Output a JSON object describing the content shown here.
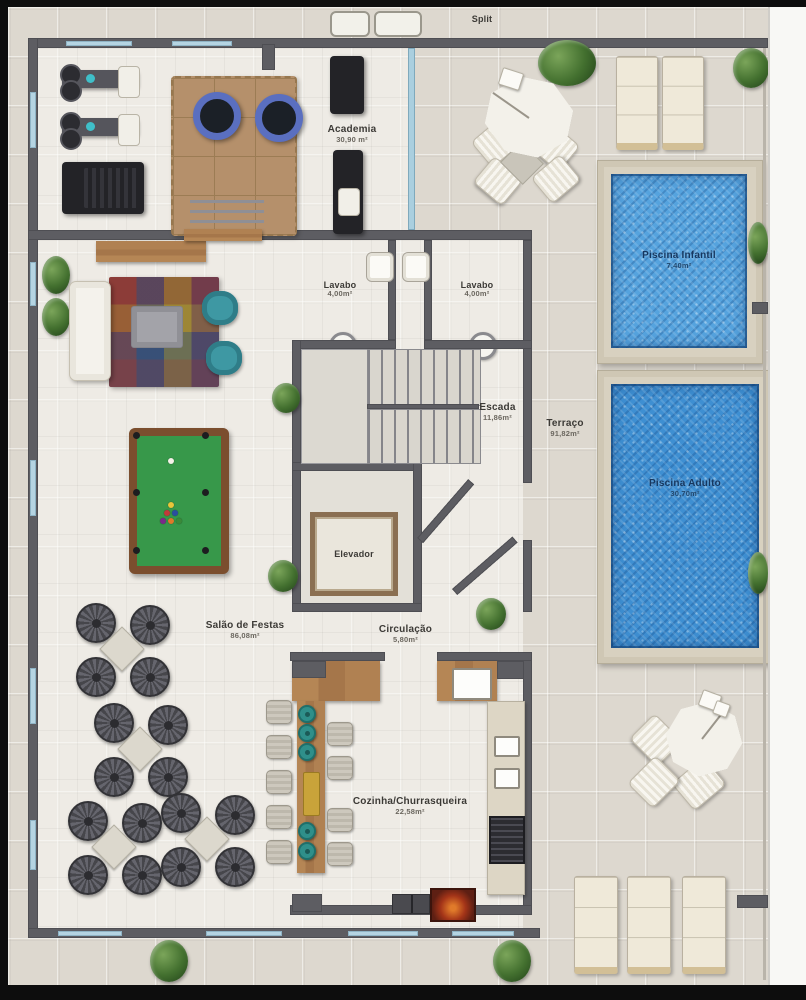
{
  "title": "Residential common-area floor plan",
  "rooms": {
    "split": {
      "name": "Split"
    },
    "academia": {
      "name": "Academia",
      "area": "30,90 m²"
    },
    "lavabo_left": {
      "name": "Lavabo",
      "area": "4,00m²"
    },
    "lavabo_right": {
      "name": "Lavabo",
      "area": "4,00m²"
    },
    "escada": {
      "name": "Escada",
      "area": "11,86m²"
    },
    "terraco": {
      "name": "Terraço",
      "area": "91,82m²"
    },
    "piscina_infantil": {
      "name": "Piscina Infantil",
      "area": "7,40m²"
    },
    "piscina_adulto": {
      "name": "Piscina Adulto",
      "area": "30,70m²"
    },
    "elevador": {
      "name": "Elevador"
    },
    "salao_de_festas": {
      "name": "Salão de Festas",
      "area": "86,08m²"
    },
    "circulacao": {
      "name": "Circulação",
      "area": "5,80m²"
    },
    "cozinha_churrasqueira": {
      "name": "Cozinha/Churrasqueira",
      "area": "22,58m²"
    }
  },
  "colors": {
    "frame": "#0d0d0d",
    "wall": "#5d5d62",
    "floor_outdoor": "#ddd8cf",
    "floor_indoor": "#f0eee9",
    "pool_water": "#3e8fd2",
    "pool_water_light": "#55a3de",
    "pool_deck": "#d8d1c0",
    "wood": "#a97c4f",
    "billiard_felt": "#37984a",
    "armchair_teal": "#3e98a3",
    "bar_stool_teal": "#2f8f8a",
    "plant_green": "#43702f",
    "label_text": "#3c3a36",
    "pool_label_text": "#16375f"
  }
}
